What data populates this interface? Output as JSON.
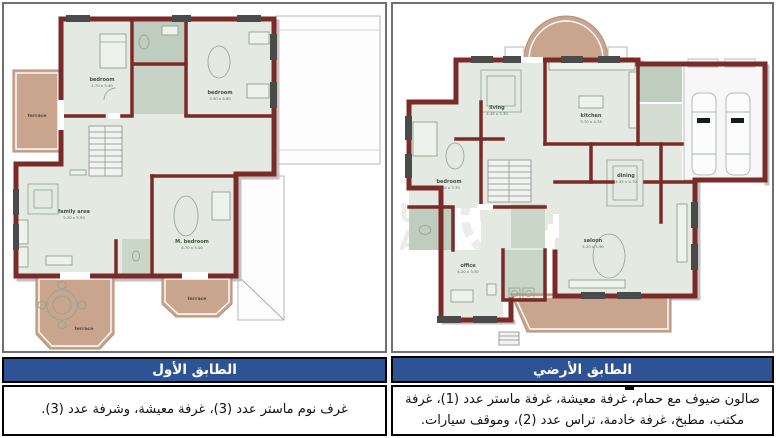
{
  "panels": {
    "first_floor": {
      "caption_title": "الطابق الأول",
      "caption_body": "غرف نوم ماستر عدد (3)، غرفة معيشة، وشرفة عدد (3).",
      "rooms": [
        {
          "label": "bedroom",
          "dims": "4.70 x 5.40"
        },
        {
          "label": "bedroom",
          "dims": "3.30 x 4.80"
        },
        {
          "label": "family area",
          "dims": "5.20 x 5.50"
        },
        {
          "label": "M. bedroom",
          "dims": "4.70 x 5.00"
        },
        {
          "label": "terrace"
        },
        {
          "label": "terrace"
        },
        {
          "label": "terrace"
        }
      ]
    },
    "ground_floor": {
      "caption_title": "الطابق الأرضي",
      "caption_body": "صالون ضيوف مع حمام، غرفة معيشة، غرفة ماستر عدد (1)، غرفة مكتب، مطبخ، غرفة خادمة، تراس عدد (2)، وموقف سيارات.",
      "rooms": [
        {
          "label": "living",
          "dims": "4.45 x 5.30"
        },
        {
          "label": "kitchen",
          "dims": "3.70 x 4.35"
        },
        {
          "label": "bedroom",
          "dims": "3.40 x 3.70"
        },
        {
          "label": "dining",
          "dims": "4.45 x 4.70"
        },
        {
          "label": "saloon",
          "dims": "5.20 x 5.90"
        },
        {
          "label": "office",
          "dims": "4.20 x 3.30"
        }
      ],
      "watermark": {
        "line1": "US",
        "line2": "AR"
      }
    }
  },
  "colors": {
    "caption_header_bg": "#2e5394",
    "wall_maroon": "#7b2a2a",
    "terrace_tan": "#c9a58e",
    "room_sage": "#e4eae2"
  }
}
